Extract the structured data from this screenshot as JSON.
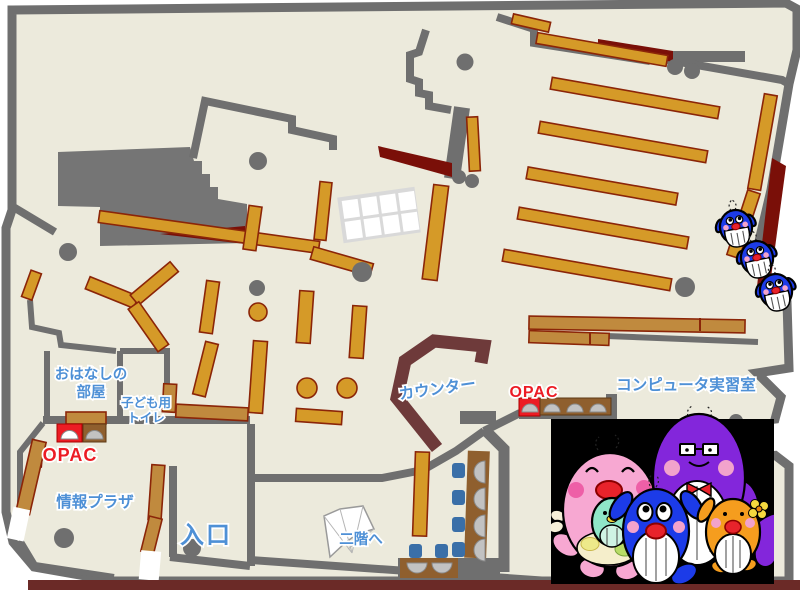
{
  "title": "library-first-floor-map",
  "labels": {
    "story_room_line1": "おはなしの",
    "story_room_line2": "部屋",
    "kids_toilet_line1": "子ども用",
    "kids_toilet_line2": "トイレ",
    "opac_left": "OPAC",
    "opac_right": "OPAC",
    "info_plaza": "情報プラザ",
    "entrance": "入口",
    "counter": "カウンター",
    "computer_room": "コンピュータ実習室",
    "to_second_floor": "二階へ"
  },
  "colors": {
    "floor": "#ECEADC",
    "wall_gray": "#6F6F6F",
    "storage_gray": "#757575",
    "shelf_orange": "#D59A28",
    "shelf_tan": "#C08A3E",
    "shelf_outline": "#8B2508",
    "desk_brown": "#8F5F2E",
    "accent_dark_red": "#7A0F08",
    "counter_maroon": "#6E3A3A",
    "bottom_strip": "#6B2A27",
    "label_blue": "#4E90D6",
    "label_red": "#EC1C24",
    "chair_blue": "#3A6FA8",
    "monitor_gray": "#C2C2C2",
    "door_white": "#FFFFFF",
    "photo_black": "#000000",
    "mascot_pink": "#F7A8D2",
    "mascot_blue": "#1C3BE8",
    "mascot_purple": "#8326DB",
    "mascot_orange": "#F59D1E",
    "mascot_teal": "#8FE6C8",
    "cheek_pink": "#F2A3CC",
    "mouth_red": "#E8232B",
    "flower_yellow": "#F5D93E"
  }
}
